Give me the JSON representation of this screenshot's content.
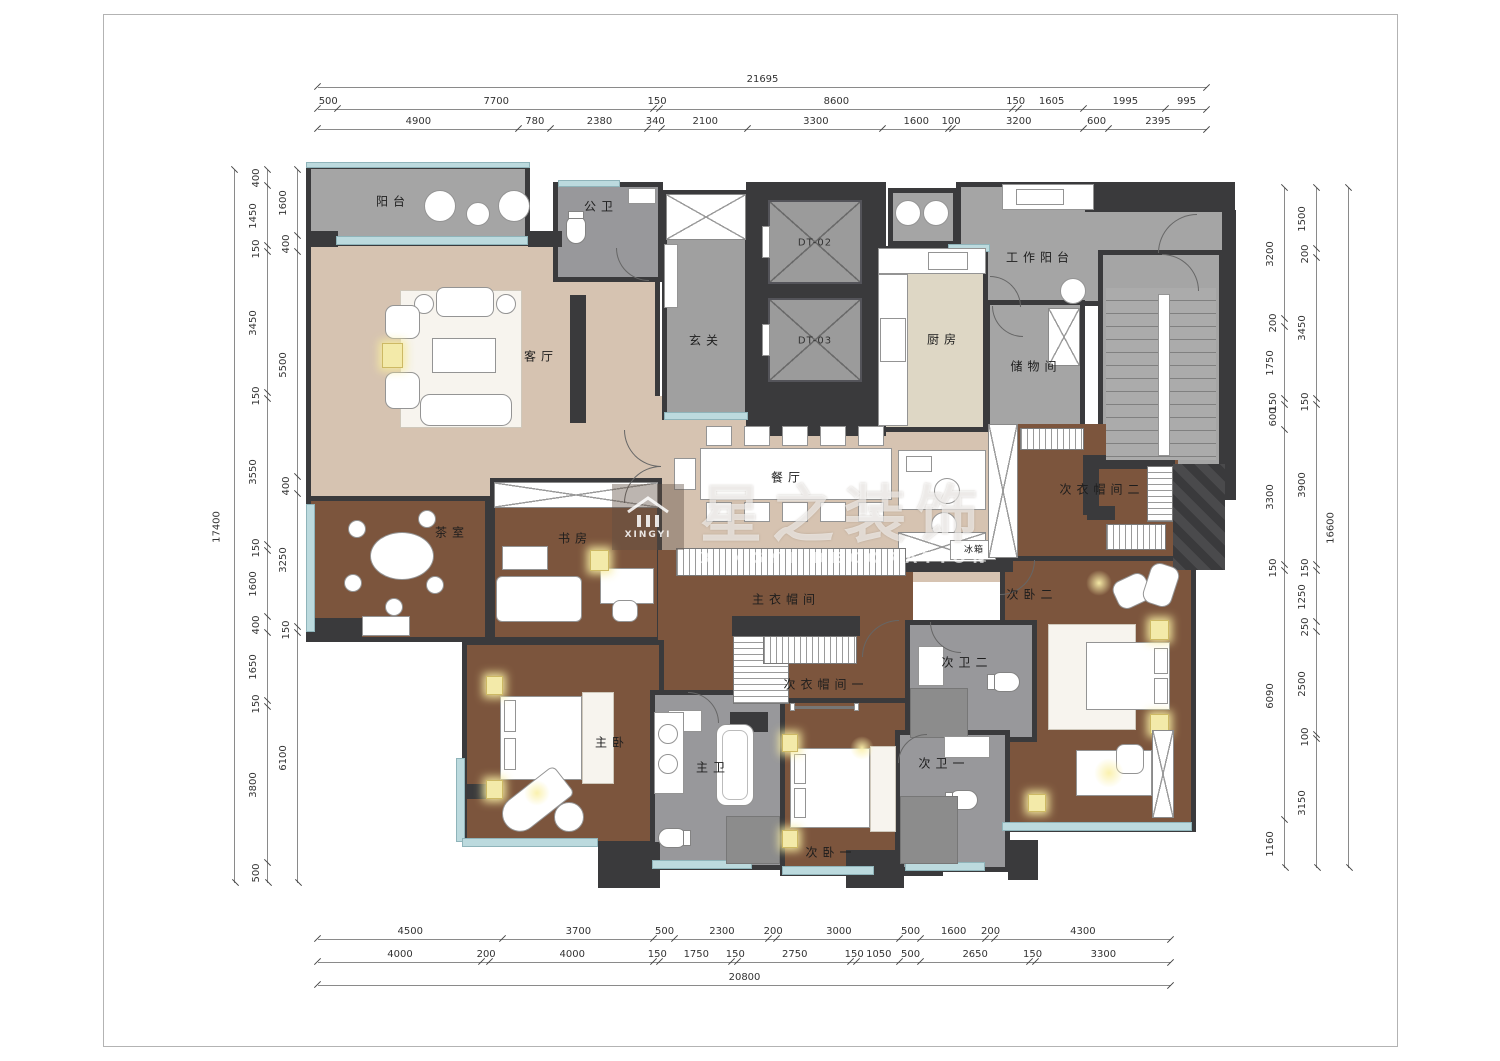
{
  "watermark": {
    "brand_cn": "星之装饰",
    "brand_en": "XINGYI DECORATION",
    "logo_caption": "XINGYI"
  },
  "rooms": {
    "balcony": "阳台",
    "public_bath": "公卫",
    "living": "客厅",
    "foyer": "玄关",
    "elevator1": "DT-02",
    "elevator2": "DT-03",
    "kitchen": "厨房",
    "work_balcony": "工作阳台",
    "storage": "储物间",
    "dining": "餐厅",
    "fridge": "冰箱",
    "tea_room": "茶室",
    "study": "书房",
    "master_closet": "主衣帽间",
    "closet1": "次衣帽间一",
    "closet2": "次衣帽间二",
    "bedroom2": "次卧二",
    "bath2": "次卫二",
    "master_bedroom": "主卧",
    "master_bath": "主卫",
    "bedroom1": "次卧一",
    "bath1": "次卫一"
  },
  "dims": {
    "top_overall": [
      21695
    ],
    "top_row1": [
      500,
      7700,
      150,
      8600,
      150,
      1605,
      1995,
      995
    ],
    "top_row2": [
      4900,
      780,
      2380,
      340,
      2100,
      3300,
      1600,
      100,
      3200,
      600,
      2395
    ],
    "bottom_row1": [
      4500,
      3700,
      500,
      2300,
      200,
      3000,
      500,
      1600,
      200,
      4300
    ],
    "bottom_row2": [
      4000,
      200,
      4000,
      150,
      1750,
      150,
      2750,
      150,
      1050,
      500,
      2650,
      150,
      3300
    ],
    "bottom_overall": [
      20800
    ],
    "left_overall": [
      17400
    ],
    "left_mid": [
      400,
      1450,
      150,
      3450,
      150,
      3550,
      150,
      1600,
      400,
      1650,
      150,
      3800,
      500
    ],
    "left_inner": [
      1600,
      400,
      5500,
      400,
      3250,
      150,
      6100
    ],
    "right_inner": [
      3200,
      200,
      1750,
      150,
      600,
      3300,
      150,
      6090,
      1160
    ],
    "right_mid": [
      1500,
      200,
      3450,
      150,
      3900,
      150,
      1250,
      250,
      2500,
      100,
      3150
    ],
    "right_overall": [
      16600
    ]
  },
  "colors": {
    "wall": "#3a3a3c",
    "wood_floor": "#7c553d",
    "beige_floor": "#d6c3b1",
    "gray_floor": "#a5a5a5",
    "bath_floor": "#98989b",
    "window": "#bcdade",
    "highlight": "#f3eaa9"
  }
}
